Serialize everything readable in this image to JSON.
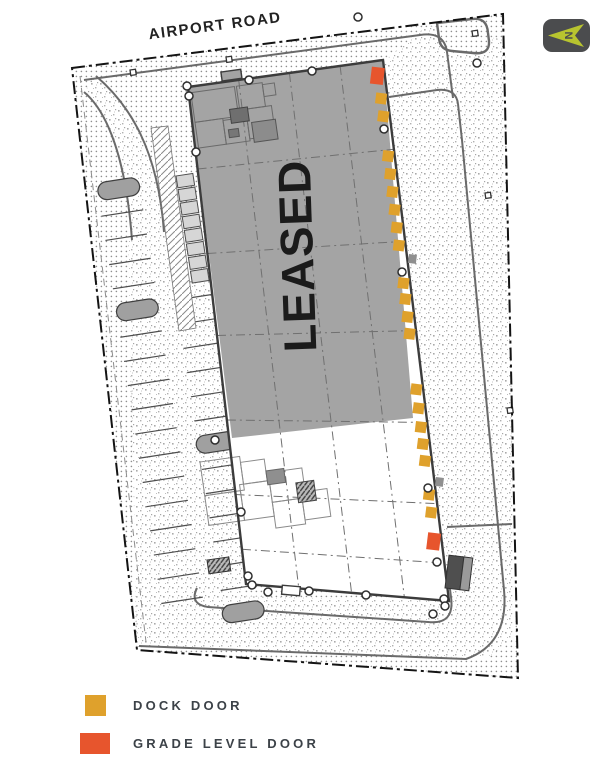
{
  "labels": {
    "road": "AIRPORT ROAD",
    "leased_area": "LEASED"
  },
  "north_arrow": {
    "letter": "N"
  },
  "legend": {
    "items": [
      {
        "label": "DOCK DOOR",
        "type": "dock"
      },
      {
        "label": "GRADE LEVEL DOOR",
        "type": "grade"
      }
    ]
  },
  "colors": {
    "dock_door": "#DFA12C",
    "grade_door": "#E7552D",
    "leased_fill": "#A4A4A4",
    "building_line": "#3C3C3C",
    "north_arrow_bg": "#4B4C4E",
    "north_arrow_glyph": "#B8C42F",
    "legend_text": "#3C4248"
  },
  "plan": {
    "doors": {
      "dock_offsets": [
        38,
        56,
        96,
        114,
        132,
        150,
        168,
        186,
        224,
        240,
        258,
        275,
        331,
        350,
        369,
        386,
        403,
        437,
        455
      ],
      "grade_offsets": [
        15,
        484
      ]
    }
  }
}
